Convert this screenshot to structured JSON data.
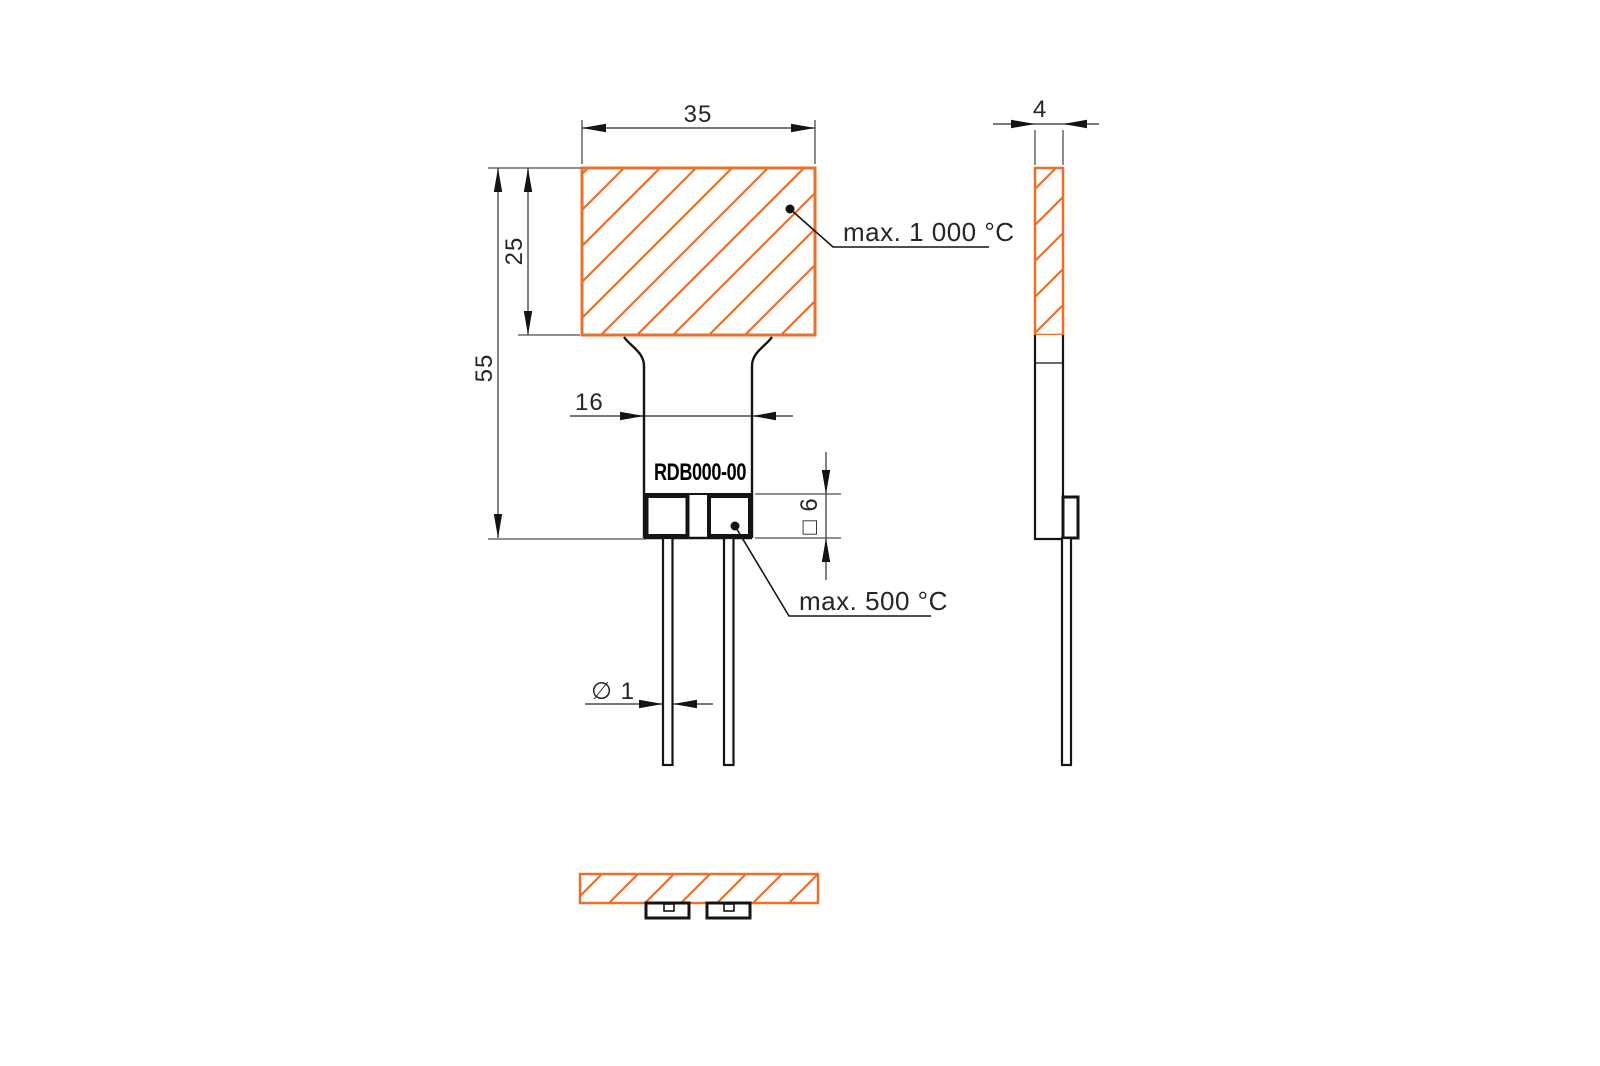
{
  "drawing": {
    "part_label": "RDB000-00",
    "labels": {
      "max_head_temp": "max. 1 000 °C",
      "max_terminal_temp": "max. 500 °C"
    },
    "dimensions": {
      "head_width_mm": "35",
      "head_height_mm": "25",
      "total_height_mm": "55",
      "neck_width_mm": "16",
      "wire_diameter": "∅ 1",
      "terminal_square": "□ 6",
      "head_thickness_mm": "4"
    },
    "colors": {
      "hatch": "#E8702D",
      "part_line": "#141414",
      "dim_line": "#4d4d4d"
    }
  }
}
